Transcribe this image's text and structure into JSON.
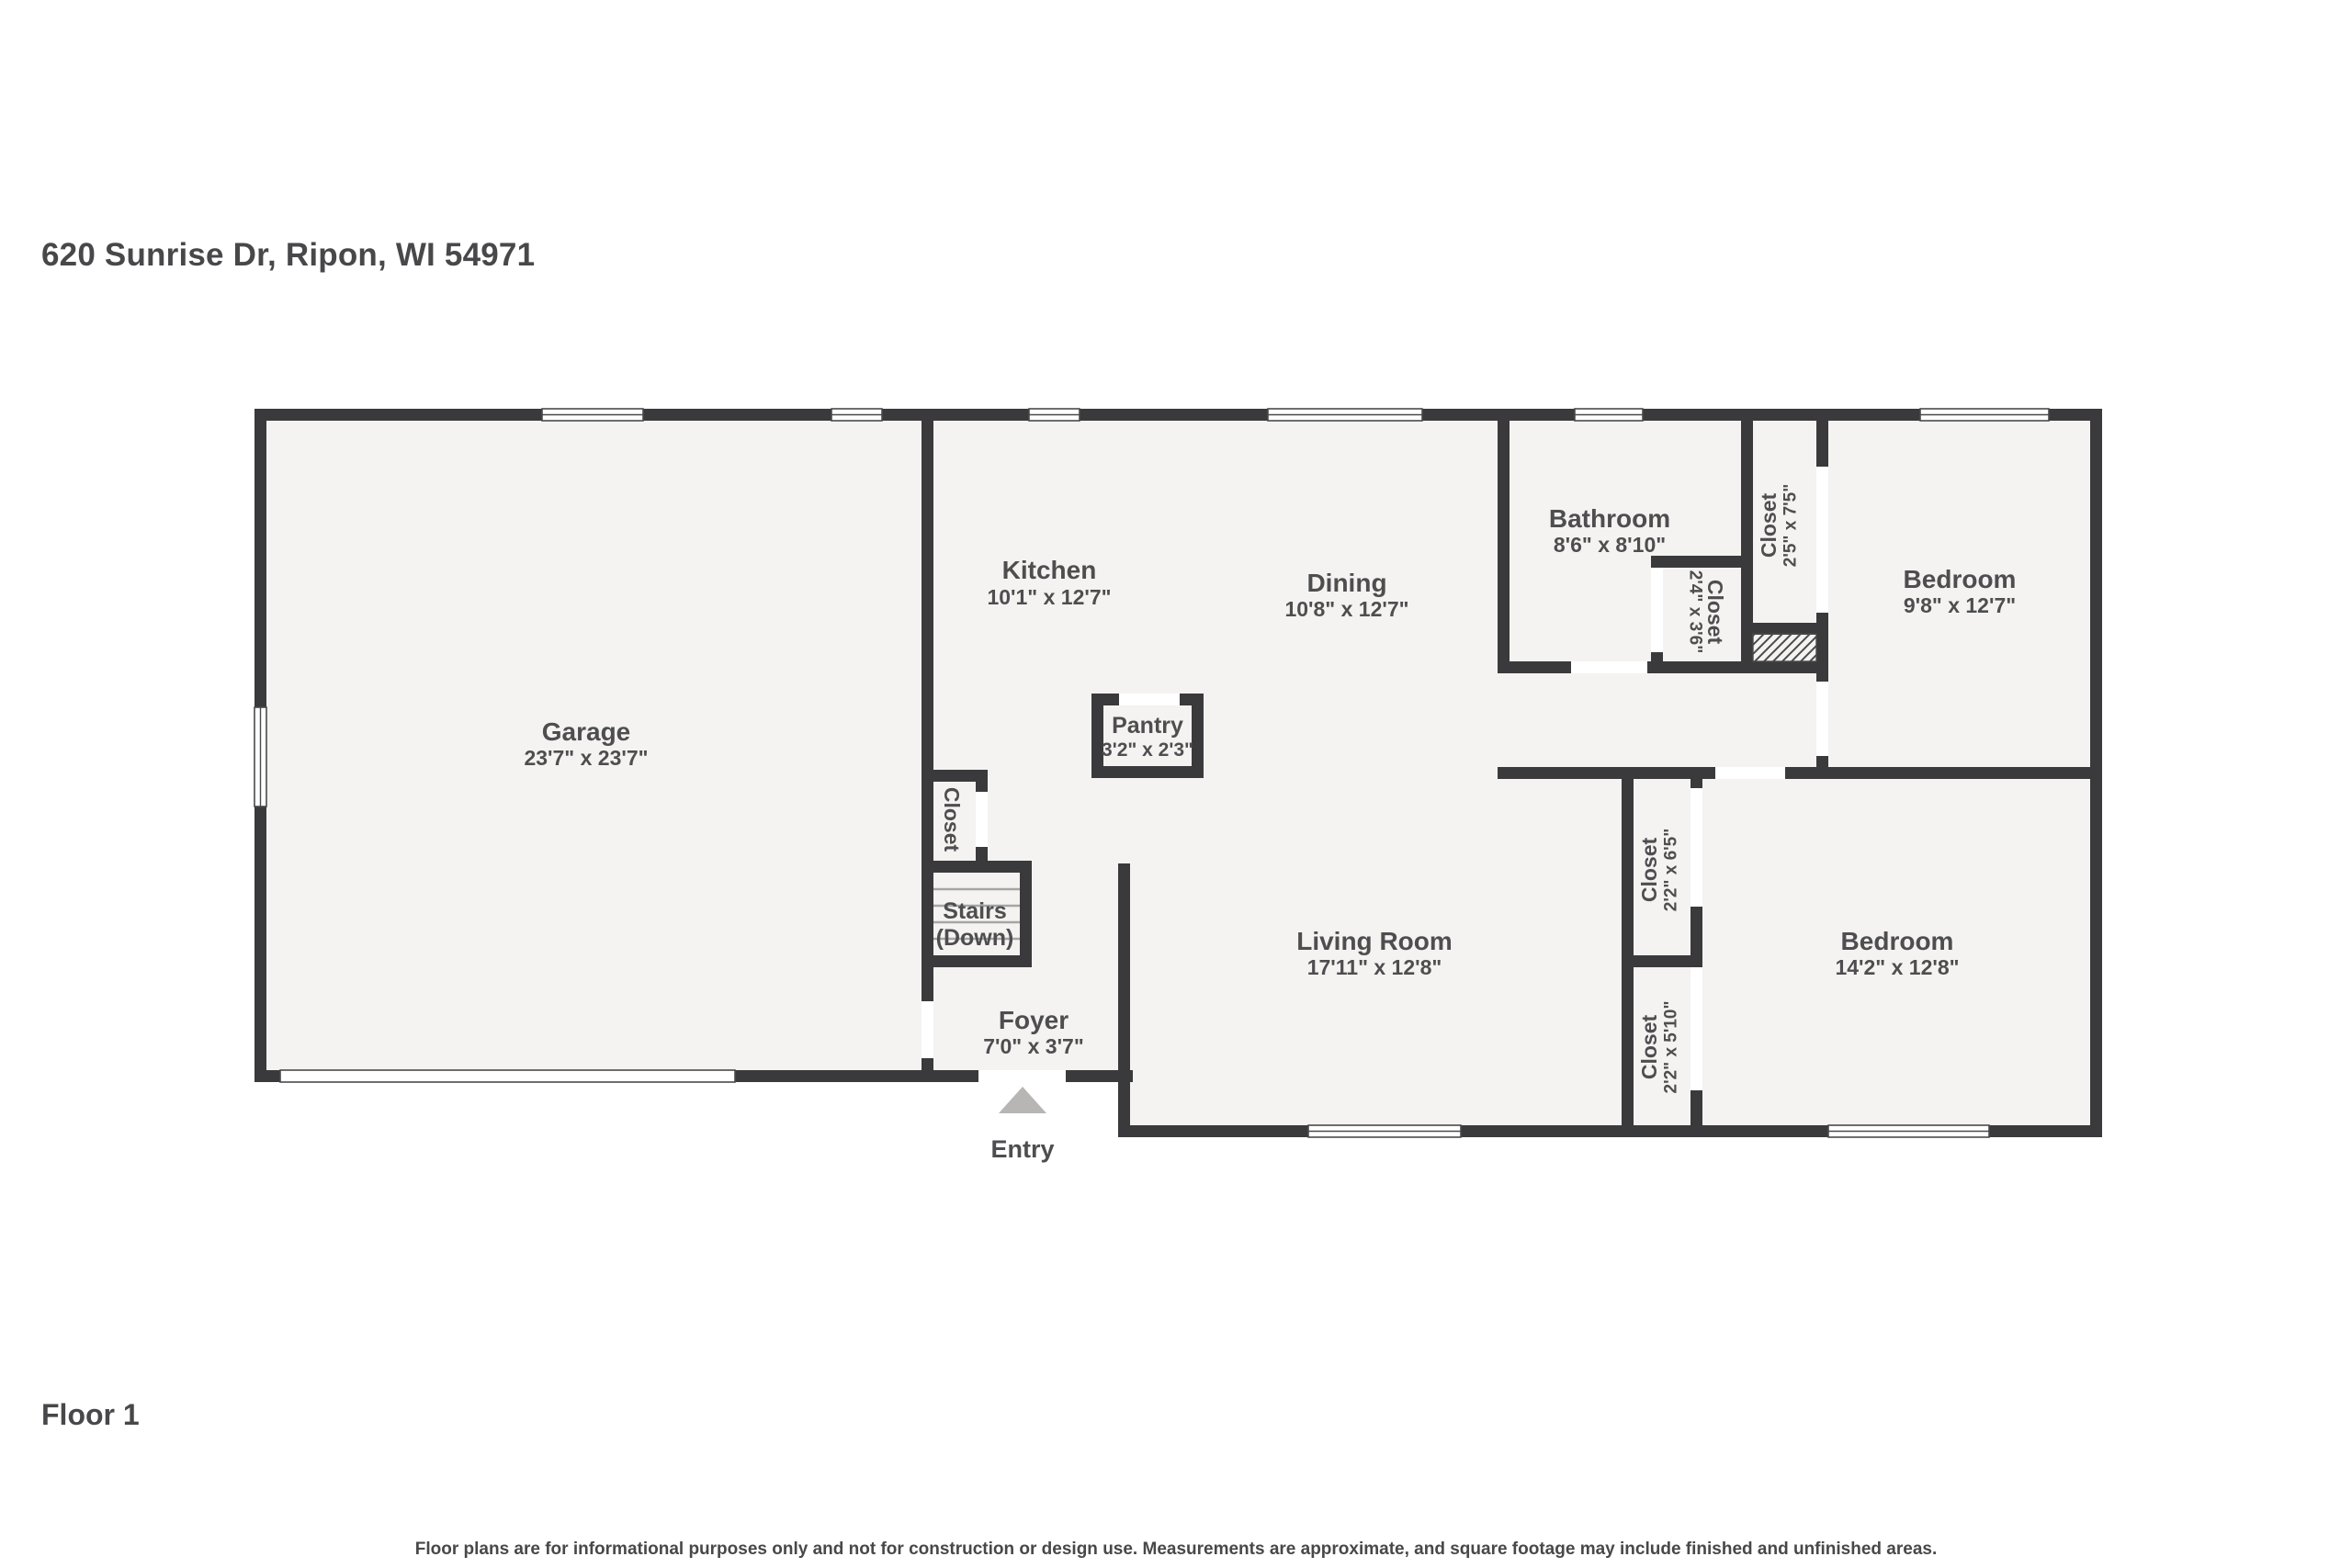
{
  "address": "620 Sunrise Dr, Ripon, WI 54971",
  "floor_label": "Floor 1",
  "disclaimer": "Floor plans are for informational purposes only and not for construction or design use. Measurements are approximate, and square footage may include finished and unfinished areas.",
  "colors": {
    "wall": "#3a3a3c",
    "floor": "#f4f3f1",
    "text": "#4e4e50",
    "text_dark": "#48484a",
    "win": "#4a4a4a",
    "entry_arrow": "#b7b6b5"
  },
  "rooms": {
    "garage": {
      "name": "Garage",
      "dims": "23'7\" x 23'7\""
    },
    "kitchen": {
      "name": "Kitchen",
      "dims": "10'1\" x 12'7\""
    },
    "dining": {
      "name": "Dining",
      "dims": "10'8\" x 12'7\""
    },
    "bathroom": {
      "name": "Bathroom",
      "dims": "8'6\" x 8'10\""
    },
    "bath_closet": {
      "name": "Closet",
      "dims": "2'4\" x 3'6\""
    },
    "hall_closet": {
      "name": "Closet",
      "dims": "2'5\" x 7'5\""
    },
    "bedroom_top": {
      "name": "Bedroom",
      "dims": "9'8\" x 12'7\""
    },
    "pantry": {
      "name": "Pantry",
      "dims": "3'2\" x 2'3\""
    },
    "stairs_closet": {
      "name": "Closet"
    },
    "stairs": {
      "name": "Stairs",
      "sub": "(Down)"
    },
    "foyer": {
      "name": "Foyer",
      "dims": "7'0\" x 3'7\""
    },
    "living_room": {
      "name": "Living Room",
      "dims": "17'11\" x 12'8\""
    },
    "closet_upper": {
      "name": "Closet",
      "dims": "2'2\" x 6'5\""
    },
    "closet_lower": {
      "name": "Closet",
      "dims": "2'2\" x 5'10\""
    },
    "bedroom_bottom": {
      "name": "Bedroom",
      "dims": "14'2\" x 12'8\""
    },
    "entry": {
      "name": "Entry"
    }
  }
}
